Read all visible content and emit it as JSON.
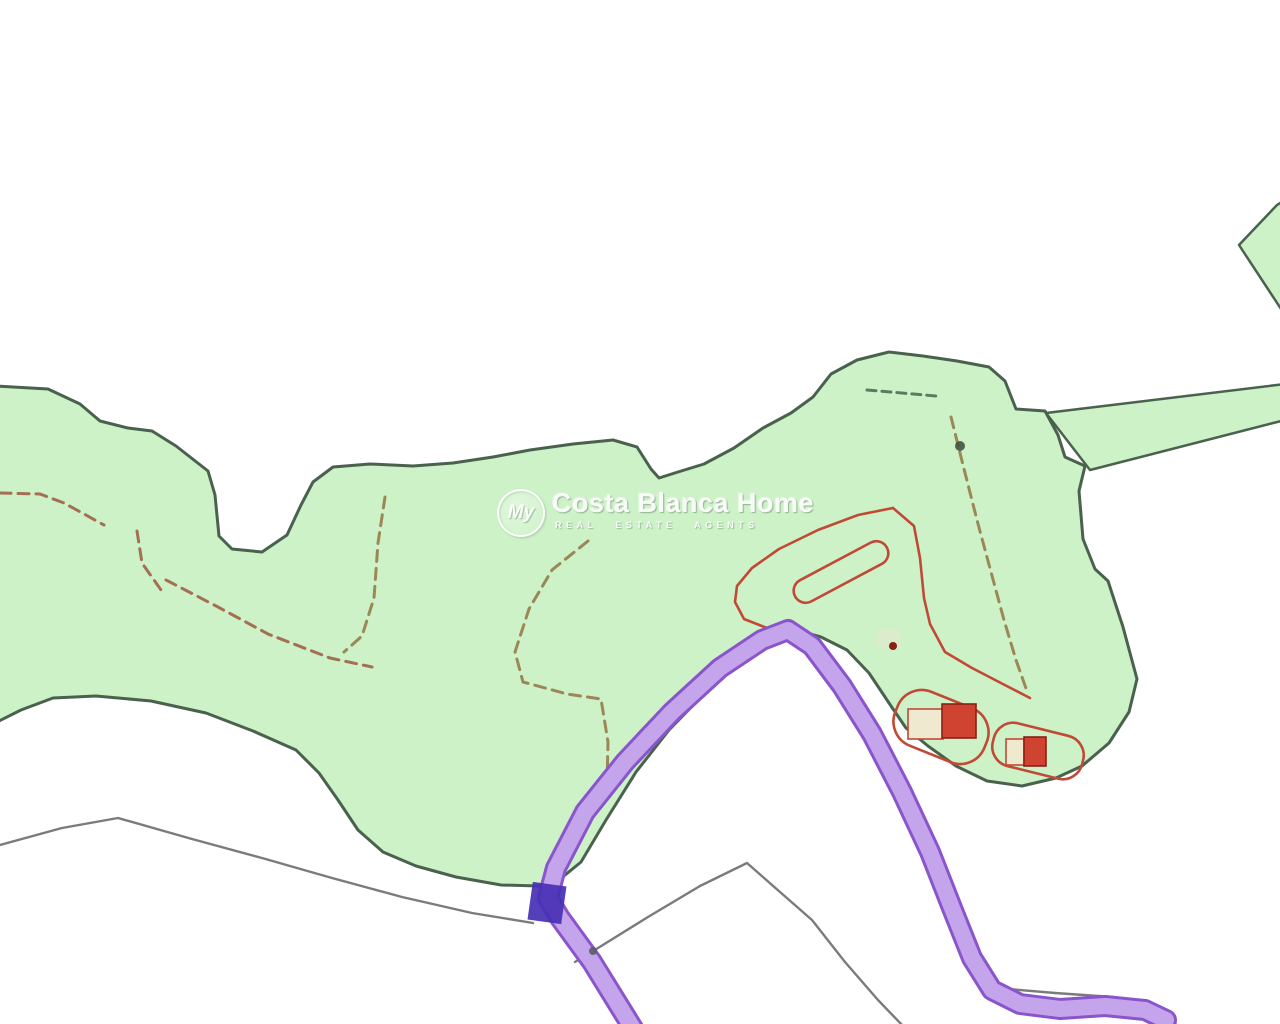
{
  "map": {
    "description": "cadastral parcel map with green rustic land parcel, purple road and red building footprints",
    "watermark": {
      "logo_text": "My",
      "title": "Costa Blanca Home",
      "subtitle": "REAL ESTATE AGENTS"
    },
    "colors": {
      "background": "#ffffff",
      "parcel_fill": "#cdf2c8",
      "parcel_outline": "#4a614e",
      "road_fill": "#c4a4ea",
      "road_casing": "#8a55cc",
      "road_marker": "#4630b5",
      "red_boundary": "#c04a36",
      "building_red": "#cf4330",
      "building_red_dark": "#8b2015",
      "building_pale": "#eee9cf",
      "dashed_olive": "#9c8756",
      "dashed_tan": "#a56f52",
      "dashed_dark_green": "#5d7a5e",
      "thin_gray": "#7b7b7b"
    }
  }
}
